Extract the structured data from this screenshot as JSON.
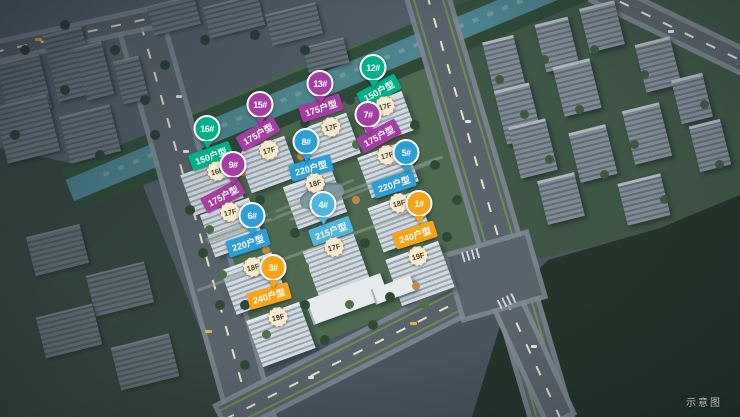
{
  "watermark": "示意图",
  "site_map": {
    "colors": {
      "type_150": "#00b189",
      "type_175": "#a53ea2",
      "type_220": "#2d9fd6",
      "type_215": "#4fb6dd",
      "type_240": "#f6a418",
      "floor_badge_bg": "#f5ead2",
      "floor_badge_text": "#5a4326"
    },
    "markers": [
      {
        "num": "16#",
        "unit_type": "150户型",
        "floors": "16F",
        "color_key": "green"
      },
      {
        "num": "15#",
        "unit_type": "175户型",
        "floors": "17F",
        "color_key": "purple"
      },
      {
        "num": "13#",
        "unit_type": "175户型",
        "floors": "17F",
        "color_key": "purple"
      },
      {
        "num": "12#",
        "unit_type": "150户型",
        "floors": "17F",
        "color_key": "green"
      },
      {
        "num": "9#",
        "unit_type": "175户型",
        "floors": "17F",
        "color_key": "purple"
      },
      {
        "num": "7#",
        "unit_type": "175户型",
        "floors": "17F",
        "color_key": "purple"
      },
      {
        "num": "8#",
        "unit_type": "220户型",
        "floors": "18F",
        "color_key": "blue"
      },
      {
        "num": "5#",
        "unit_type": "220户型",
        "floors": "18F",
        "color_key": "blue"
      },
      {
        "num": "6#",
        "unit_type": "220户型",
        "floors": "18F",
        "color_key": "blue"
      },
      {
        "num": "4#",
        "unit_type": "215户型",
        "floors": "17F",
        "color_key": "cyan"
      },
      {
        "num": "3#",
        "unit_type": "240户型",
        "floors": "19F",
        "color_key": "orange"
      },
      {
        "num": "1#",
        "unit_type": "240户型",
        "floors": "19F",
        "color_key": "orange"
      }
    ]
  }
}
